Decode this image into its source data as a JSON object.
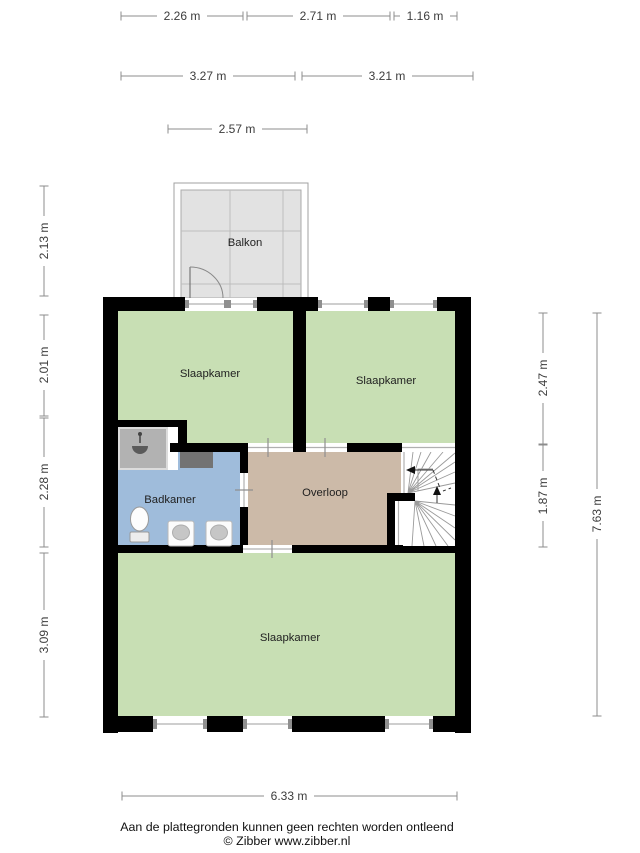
{
  "plan_title": "floorplan-first-floor",
  "rooms": {
    "balkon": "Balkon",
    "slaapkamer_top_left": "Slaapkamer",
    "slaapkamer_top_right": "Slaapkamer",
    "badkamer": "Badkamer",
    "overloop": "Overloop",
    "slaapkamer_bottom": "Slaapkamer"
  },
  "dimensions": {
    "top_row": [
      "2.26 m",
      "2.71 m",
      "1.16 m"
    ],
    "second_row": [
      "3.27 m",
      "3.21 m"
    ],
    "balkon_width": "2.57 m",
    "left_column": [
      "2.13 m",
      "2.01 m",
      "2.28 m",
      "3.09 m"
    ],
    "right_inner": [
      "2.47 m",
      "1.87 m"
    ],
    "right_total": "7.63 m",
    "bottom_width": "6.33 m"
  },
  "footer": {
    "disclaimer": "Aan de plattegronden kunnen geen rechten worden ontleend",
    "credit": "© Zibber www.zibber.nl"
  },
  "colors": {
    "wall": "#000000",
    "bedroom_green": "#c8dfb4",
    "bathroom_blue": "#9fbcdb",
    "landing_tan": "#ccbaa8",
    "balcony_gray": "#e2e2e2",
    "shower_gray": "#b2b2b2",
    "cabinet_gray": "#737373",
    "dimension_line": "#8c8c8c"
  }
}
